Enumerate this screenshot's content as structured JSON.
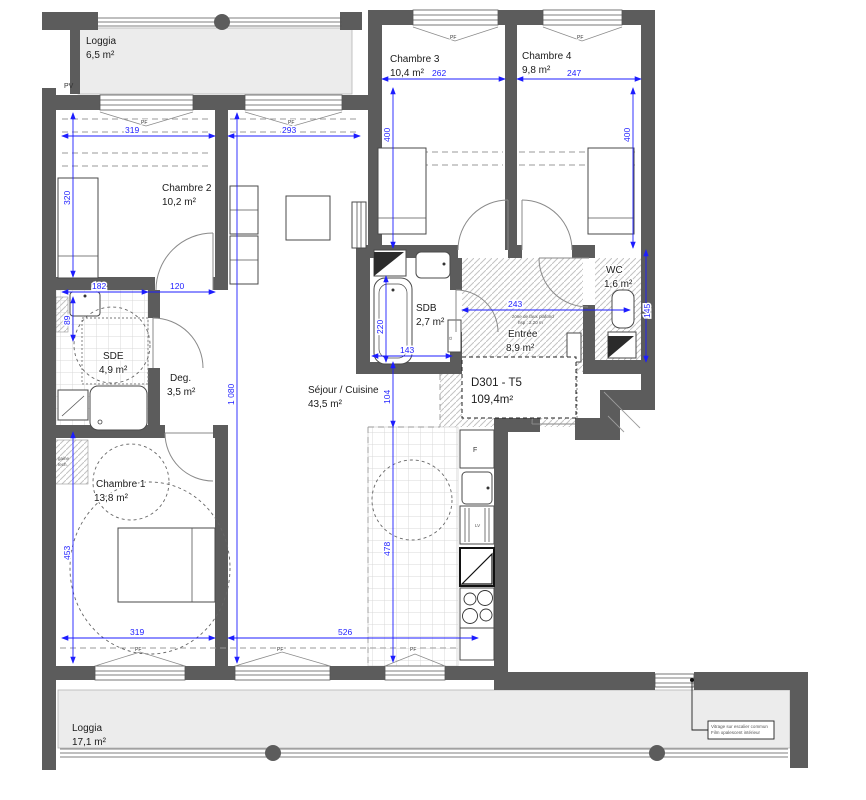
{
  "plan": {
    "unit": {
      "line1": "D301 - T5",
      "line2": "109,4m²"
    },
    "rooms": [
      {
        "id": "loggia-top",
        "name": "Loggia",
        "area": "6,5 m²"
      },
      {
        "id": "chambre-2",
        "name": "Chambre 2",
        "area": "10,2 m²"
      },
      {
        "id": "chambre-3",
        "name": "Chambre 3",
        "area": "10,4 m²"
      },
      {
        "id": "chambre-4",
        "name": "Chambre 4",
        "area": "9,8 m²"
      },
      {
        "id": "sde",
        "name": "SDE",
        "area": "4,9 m²"
      },
      {
        "id": "degagement",
        "name": "Deg.",
        "area": "3,5 m²"
      },
      {
        "id": "sejour-cuisine",
        "name": "Séjour / Cuisine",
        "area": "43,5 m²"
      },
      {
        "id": "sdb",
        "name": "SDB",
        "area": "2,7 m²"
      },
      {
        "id": "entree",
        "name": "Entrée",
        "area": "8,9 m²"
      },
      {
        "id": "wc",
        "name": "WC",
        "area": "1,6 m²"
      },
      {
        "id": "chambre-1",
        "name": "Chambre 1",
        "area": "13,8 m²"
      },
      {
        "id": "loggia-bottom",
        "name": "Loggia",
        "area": "17,1 m²"
      }
    ],
    "dims": {
      "ch2_w": "319",
      "sej_top_w": "293",
      "ch3_w": "262",
      "ch4_w": "247",
      "ch3_h": "400",
      "ch4_h": "400",
      "ch2_h": "320",
      "sde_w": "182",
      "deg_w": "120",
      "gaine_h": "89",
      "sejour_h": "1 080",
      "pass_h": "104",
      "cuisine_h": "478",
      "sdb_w": "143",
      "entree_w": "243",
      "bath_l": "220",
      "wc_h": "145",
      "ch1_h": "453",
      "ch1_w": "319",
      "sejour_w": "526"
    },
    "symbols": {
      "pv": "PV",
      "pf": "PF",
      "fridge": "F",
      "lv": "LV",
      "gaine": "G"
    },
    "notes": {
      "entree1": "zone de faux plafond",
      "entree2": "hsp : 2,20 m",
      "glazing1": "Vitrage sur escalier commun",
      "glazing2": "Film opalescent intérieur",
      "gaine1": "gaine",
      "gaine2": "tech."
    },
    "colors": {
      "wall": "#5c5c5c",
      "dimension": "#1d1dff",
      "loggia_floor": "#ececec"
    }
  }
}
